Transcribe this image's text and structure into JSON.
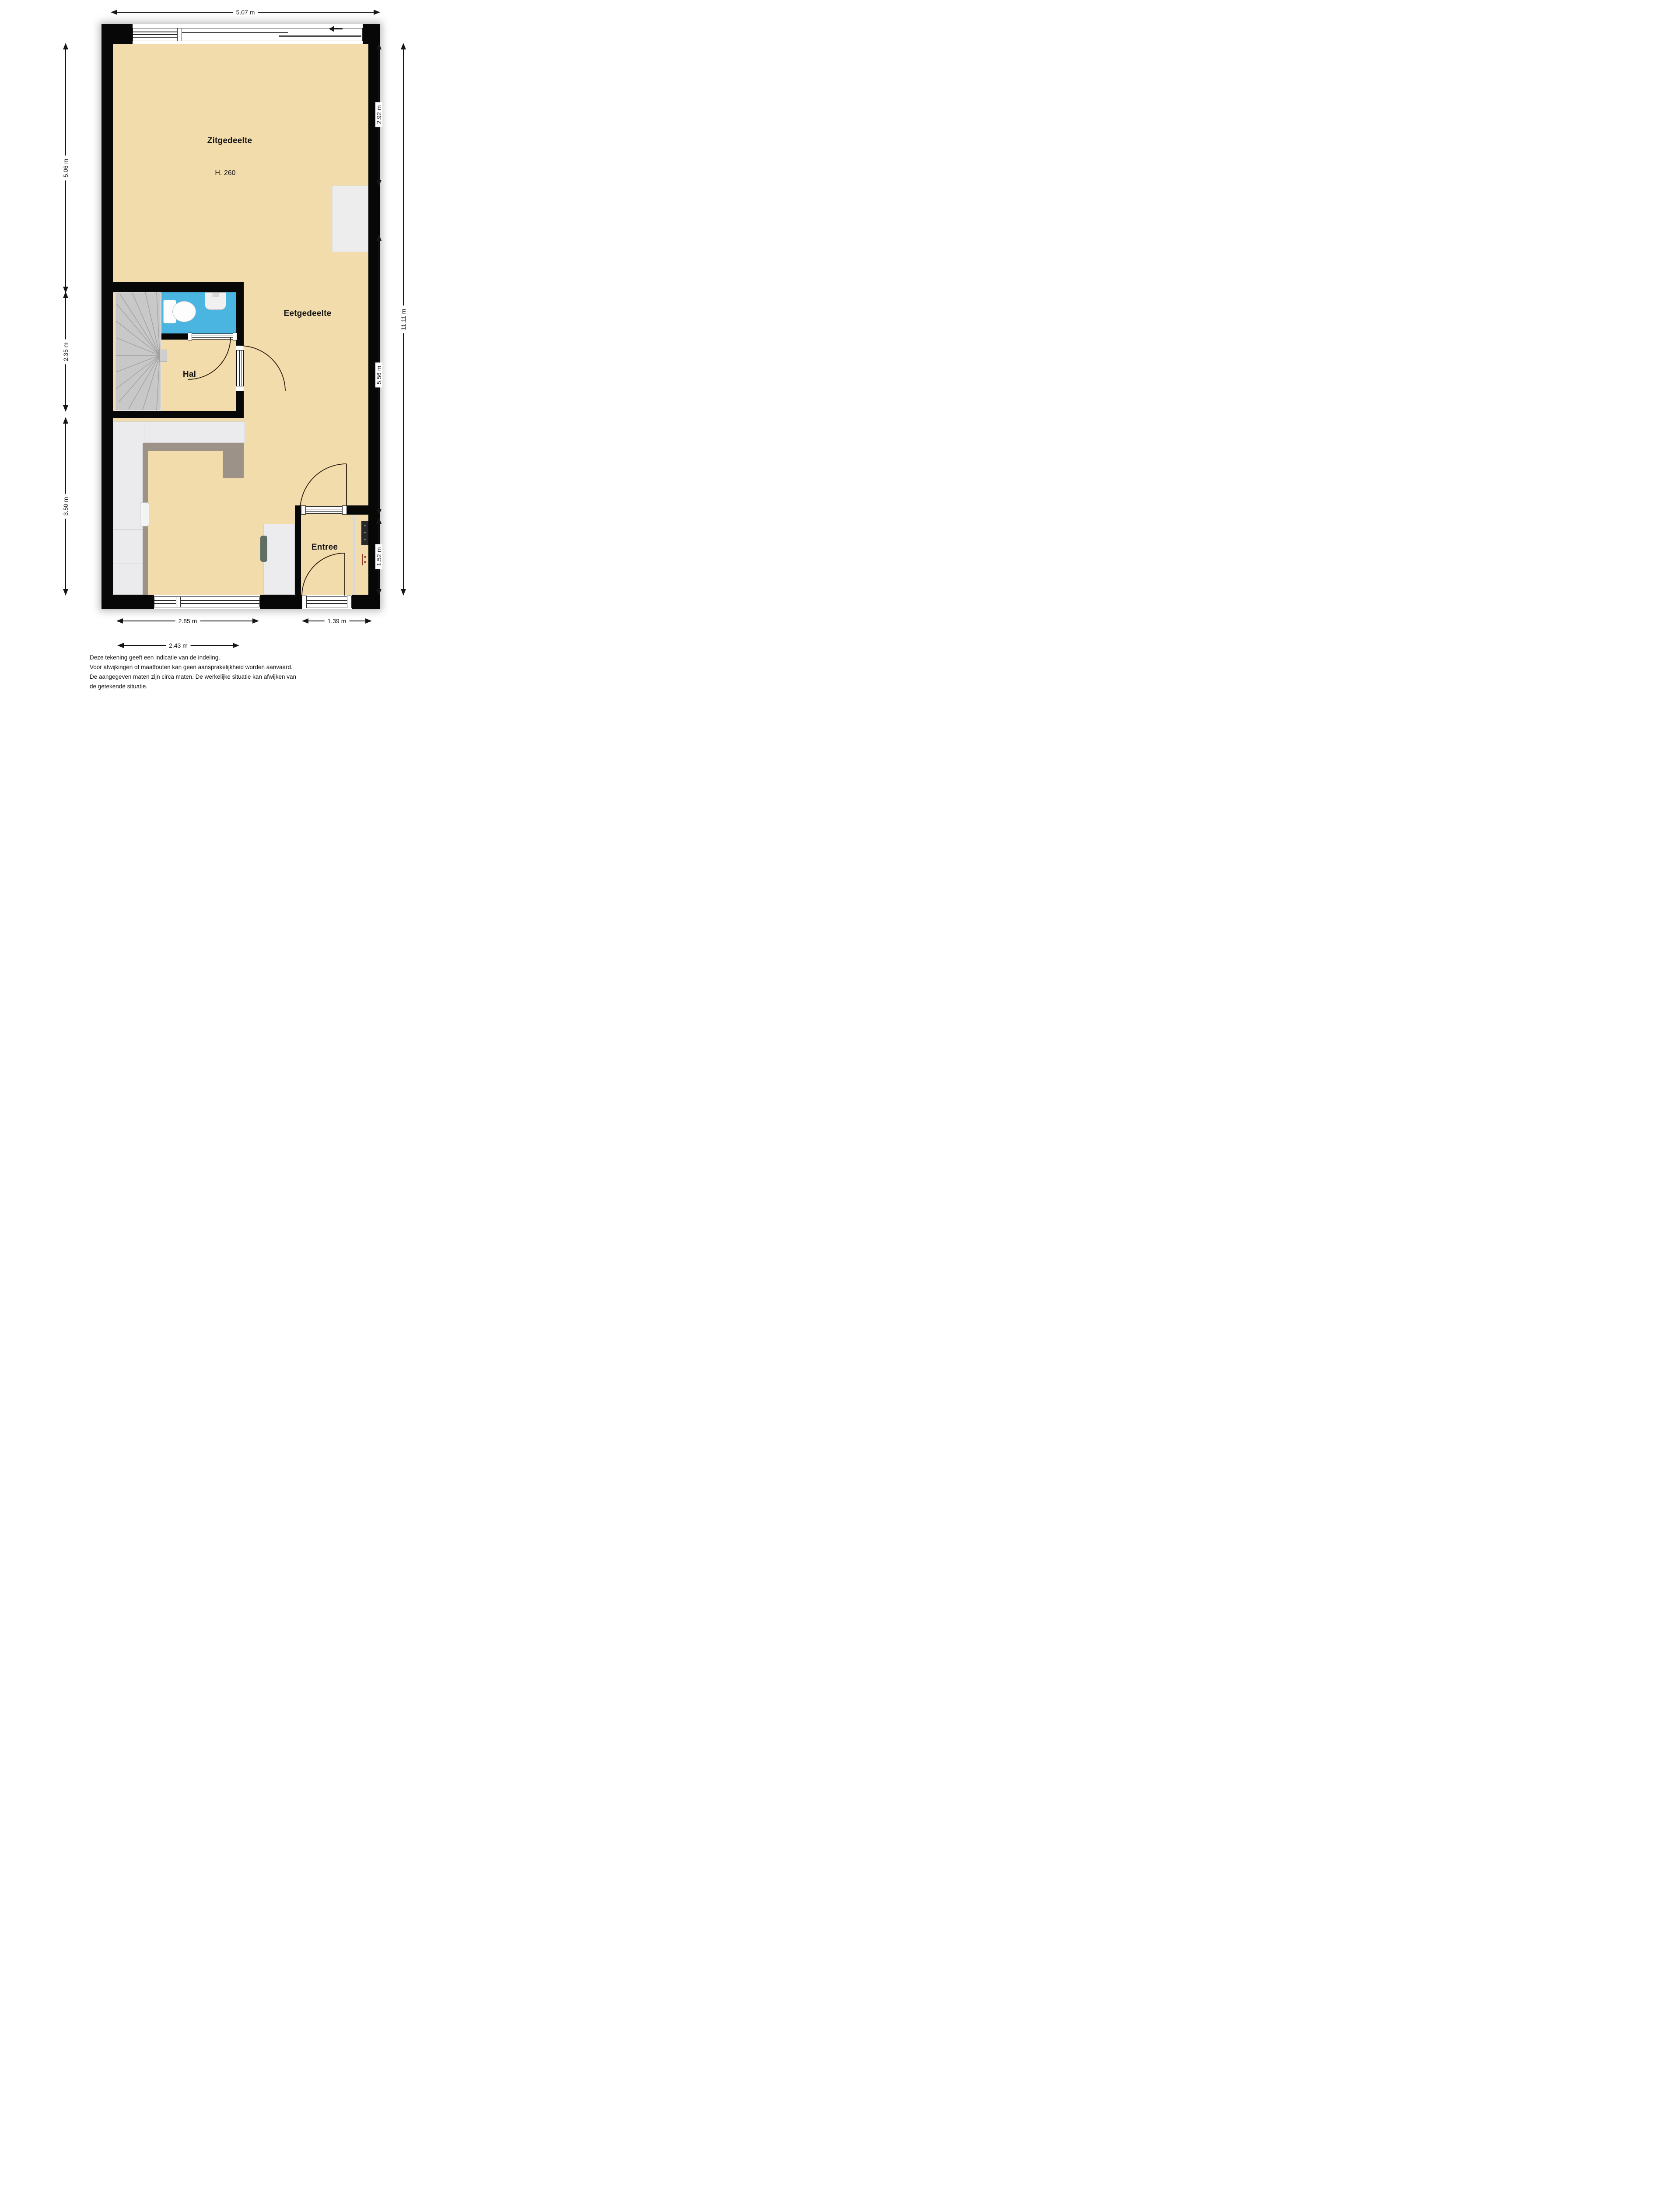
{
  "rooms": {
    "living": {
      "label": "Zitgedeelte",
      "ceiling_height": "H. 260"
    },
    "dining": {
      "label": "Eetgedeelte"
    },
    "hall": {
      "label": "Hal"
    },
    "entry": {
      "label": "Entree"
    }
  },
  "dims": {
    "width_total": "5.07 m",
    "left_top": "5.06 m",
    "left_mid": "2.35 m",
    "left_bottom": "3.50 m",
    "right_top": "2.92 m",
    "right_mid": "5.56 m",
    "right_entry": "1.52 m",
    "right_total": "11.11 m",
    "bottom_kitchen": "2.85 m",
    "bottom_entry": "1.39 m",
    "bottom_inner": "2.43 m"
  },
  "disclaimer": {
    "line1": "Deze tekening geeft een indicatie van de indeling.",
    "line2": "Voor  afwijkingen of maatfouten kan geen aansprakelijkheid worden aanvaard.",
    "line3": "De aangegeven maten zijn circa maten. De werkelijke situatie kan afwijken van",
    "line4": "de getekende situatie."
  },
  "icons": {
    "slide_direction_arrow": "left-arrow"
  },
  "colors": {
    "floor": "#f2dcab",
    "wet_room": "#4ab5e0",
    "stairs": "#c8c8c8",
    "counter": "#ebebed",
    "counter_edge": "#9c9287",
    "wall": "#070707",
    "dimension": "#161616"
  }
}
